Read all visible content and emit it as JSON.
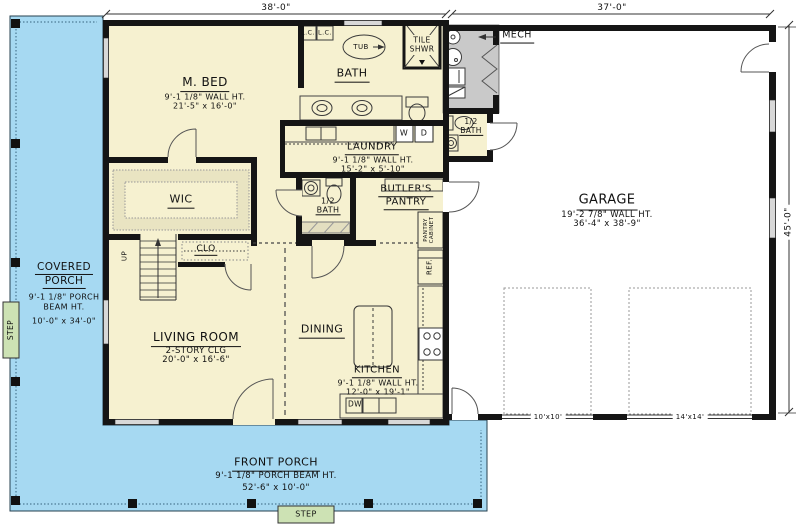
{
  "dims": {
    "top_left": "38'-0\"",
    "top_right": "37'-0\"",
    "right": "45'-0\""
  },
  "rooms": {
    "m_bed": {
      "name": "M. BED",
      "ht": "9'-1 1/8\" WALL HT.",
      "size": "21'-5\" x 16'-0\""
    },
    "bath": {
      "name": "BATH"
    },
    "laundry": {
      "name": "LAUNDRY",
      "ht": "9'-1 1/8\" WALL HT.",
      "size": "15'-2\" x 5'-10\""
    },
    "wic": {
      "name": "WIC"
    },
    "clo": {
      "name": "CLO"
    },
    "half_bath_center": {
      "l1": "1/2",
      "l2": "BATH"
    },
    "half_bath_garage": {
      "l1": "1/2",
      "l2": "BATH"
    },
    "butlers": {
      "l1": "BUTLER'S",
      "l2": "PANTRY"
    },
    "mech": {
      "name": "MECH"
    },
    "garage": {
      "name": "GARAGE",
      "ht": "19'-2 7/8\" WALL HT.",
      "size": "36'-4\" x 38'-9\""
    },
    "living": {
      "name": "LIVING ROOM",
      "clg": "2-STORY CLG",
      "size": "20'-0\" x 16'-6\""
    },
    "dining": {
      "name": "DINING"
    },
    "kitchen": {
      "name": "KITCHEN",
      "ht": "9'-1 1/8\" WALL HT.",
      "size": "12'-0\" x 19'-1\""
    },
    "covered_porch": {
      "n1": "COVERED",
      "n2": "PORCH",
      "ht1": "9'-1 1/8\" PORCH",
      "ht2": "BEAM HT.",
      "size": "10'-0\" x 34'-0\""
    },
    "front_porch": {
      "name": "FRONT PORCH",
      "ht": "9'-1 1/8\" PORCH BEAM HT.",
      "size": "52'-6\" x 10'-0\""
    }
  },
  "fixtures": {
    "tub": "TUB",
    "tile_shwr1": "TILE",
    "tile_shwr2": "SHWR",
    "lc_left": "L.C.",
    "lc_right": "L.C.",
    "washer": "W",
    "dryer": "D",
    "dw": "DW",
    "ref": "REF.",
    "pantry_cab1": "PANTRY",
    "pantry_cab2": "CABINET",
    "up": "UP",
    "step_left": "STEP",
    "step_bottom": "STEP",
    "garage_door_small": "10'x10'",
    "garage_door_large": "14'x14'"
  },
  "colors": {
    "porch": "#a6d9f2",
    "house": "#f6f1d0",
    "mech": "#c9c9c9",
    "step": "#cde2b4",
    "wall": "#151515",
    "window": "#d8d8d8"
  }
}
